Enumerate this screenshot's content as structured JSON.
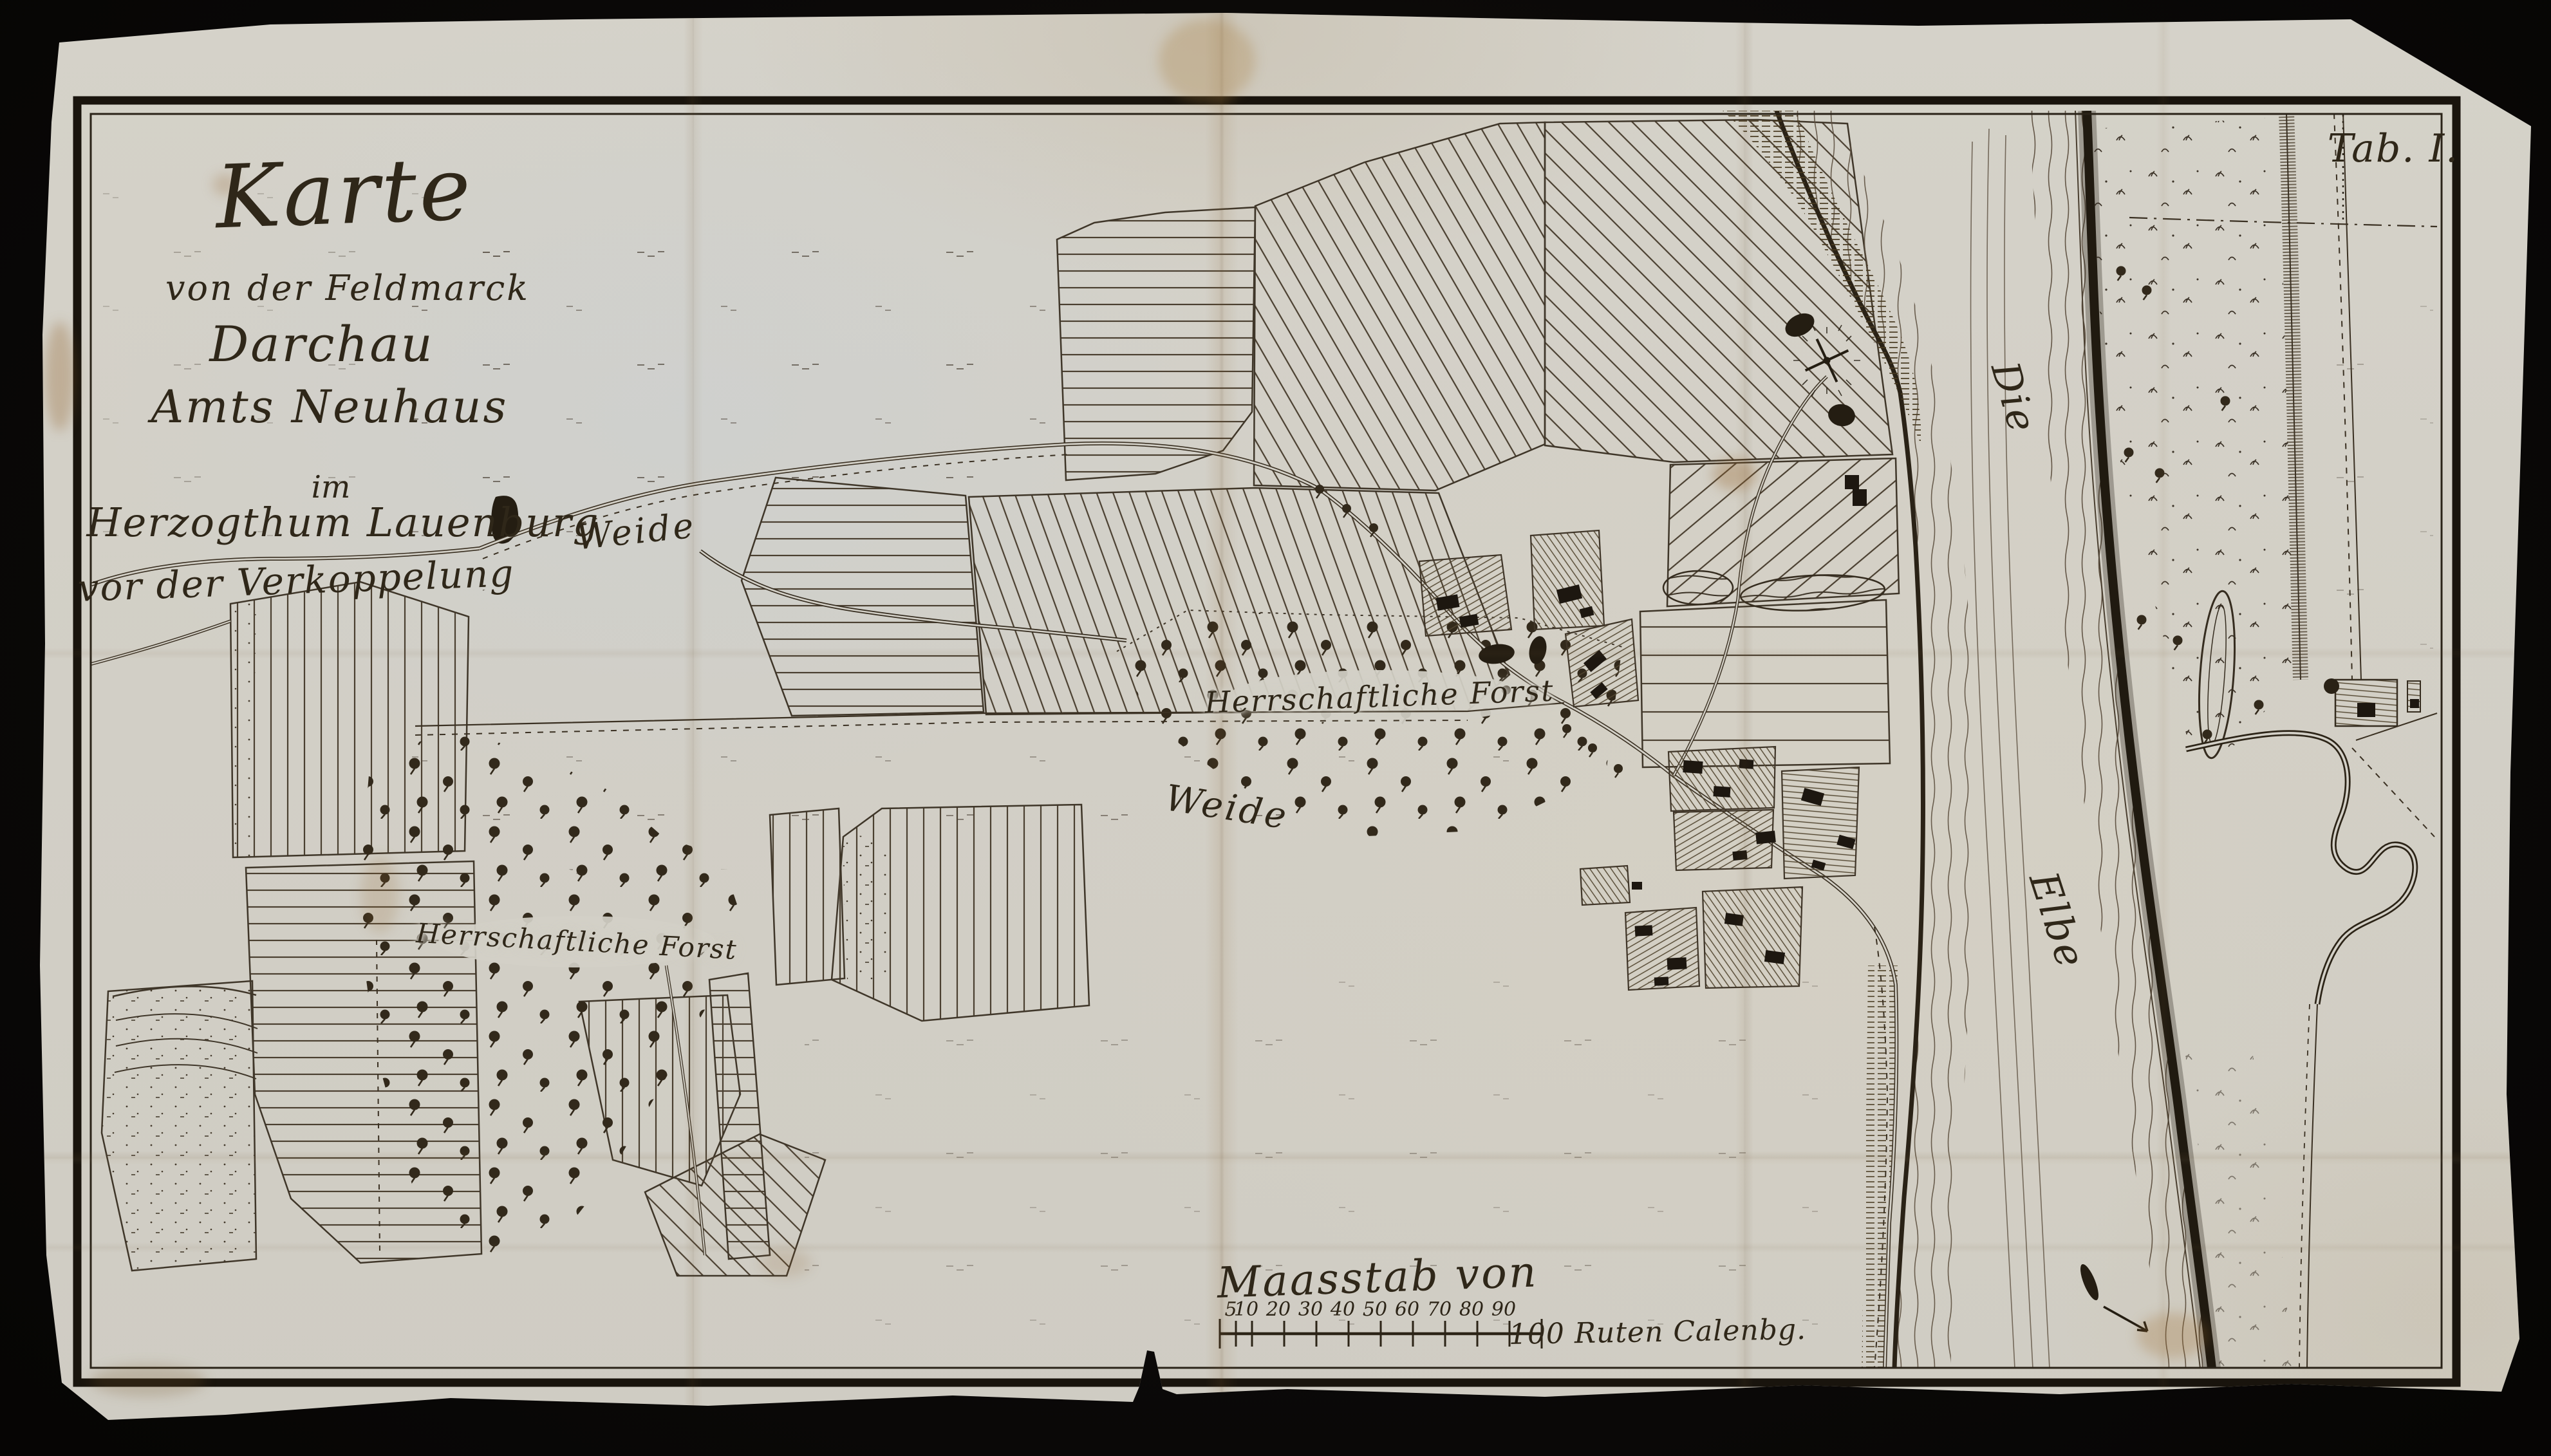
{
  "plate": {
    "tab_label": "Tab. I."
  },
  "title": {
    "lines": [
      "Karte",
      "von der Feldmarck",
      "Darchau",
      "Amts Neuhaus",
      "im",
      "Herzogthum Lauenburg",
      "vor der Verkoppelung"
    ]
  },
  "labels": {
    "pasture_north": "Weide",
    "pasture_south": "Weide",
    "forest_east": "Herrschaftliche Forst",
    "forest_west": "Herrschaftliche Forst",
    "river_line1": "Die",
    "river_line2": "Elbe"
  },
  "scalebar": {
    "caption": "Maasstab von",
    "ticks": [
      "5",
      "10",
      "20",
      "30",
      "40",
      "50",
      "60",
      "70",
      "80",
      "90"
    ],
    "end_label": "100 Ruten Calenbg."
  },
  "colors": {
    "backdrop": "#0b0908",
    "paper": "#d3d0c7",
    "ink": "#2f2719",
    "engraving_line": "#4a3f30",
    "frame": "#19140d"
  }
}
